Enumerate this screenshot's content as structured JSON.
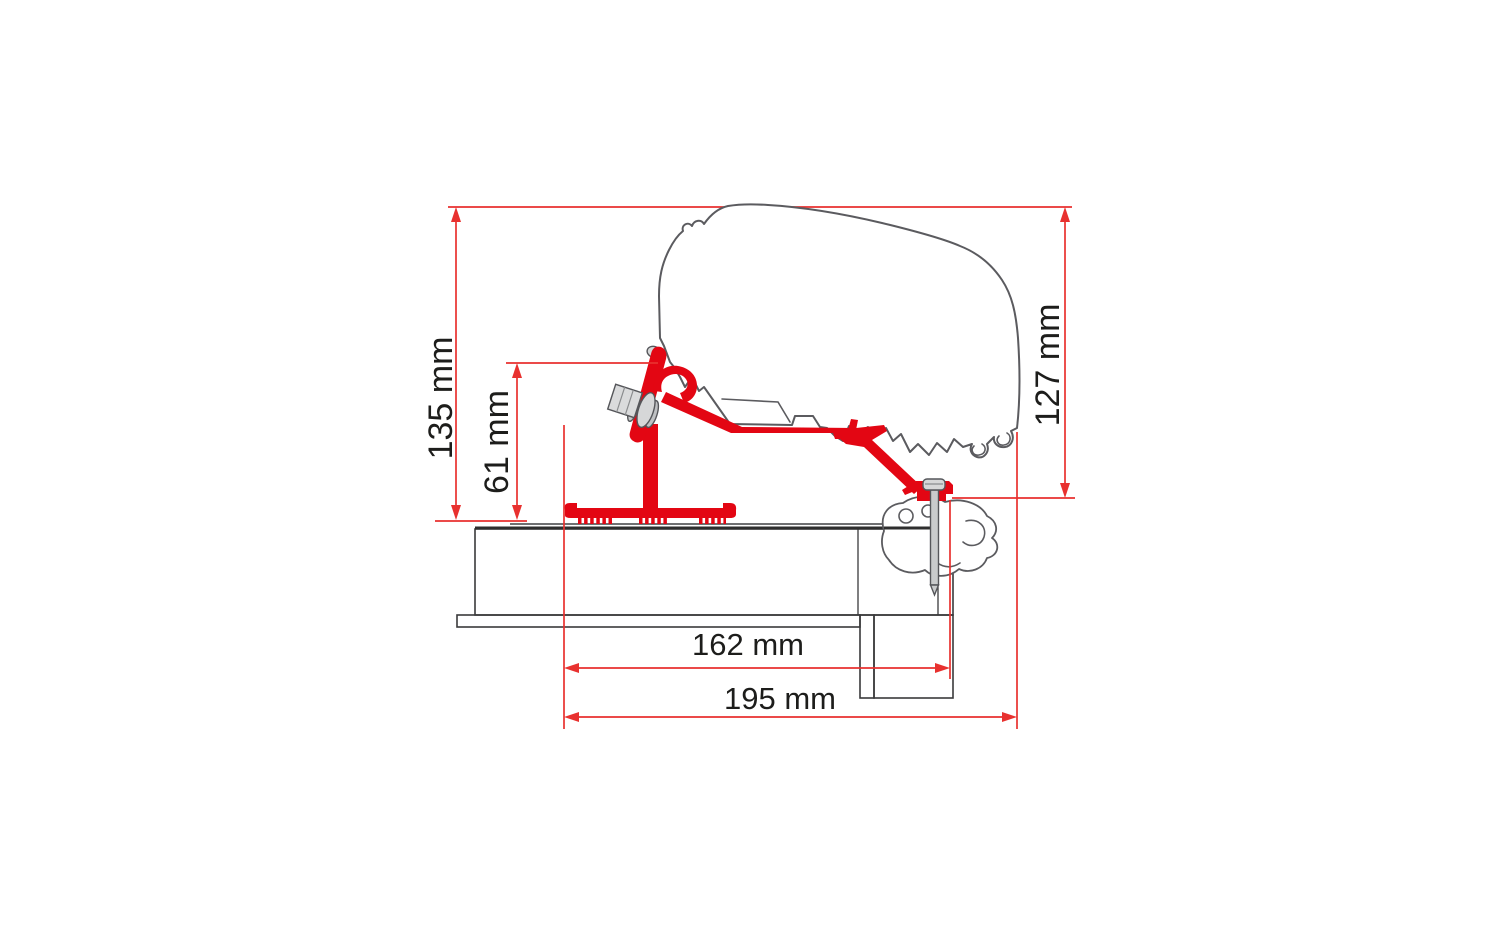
{
  "diagram": {
    "kind": "awning-adapter-cross-section",
    "labels": {
      "total_height": "135 mm",
      "bracket_height": "61 mm",
      "case_height": "127 mm",
      "roof_depth_inner": "162 mm",
      "roof_depth_outer": "195 mm"
    },
    "colors": {
      "bracket_red": "#e30613",
      "dimension_red": "#e8312f",
      "outline_gray": "#5b5b5f",
      "structure_dark": "#3a3a3b",
      "metal_gray": "#d6d7d8",
      "text_color": "#1d1d1b",
      "background": "#ffffff"
    }
  }
}
